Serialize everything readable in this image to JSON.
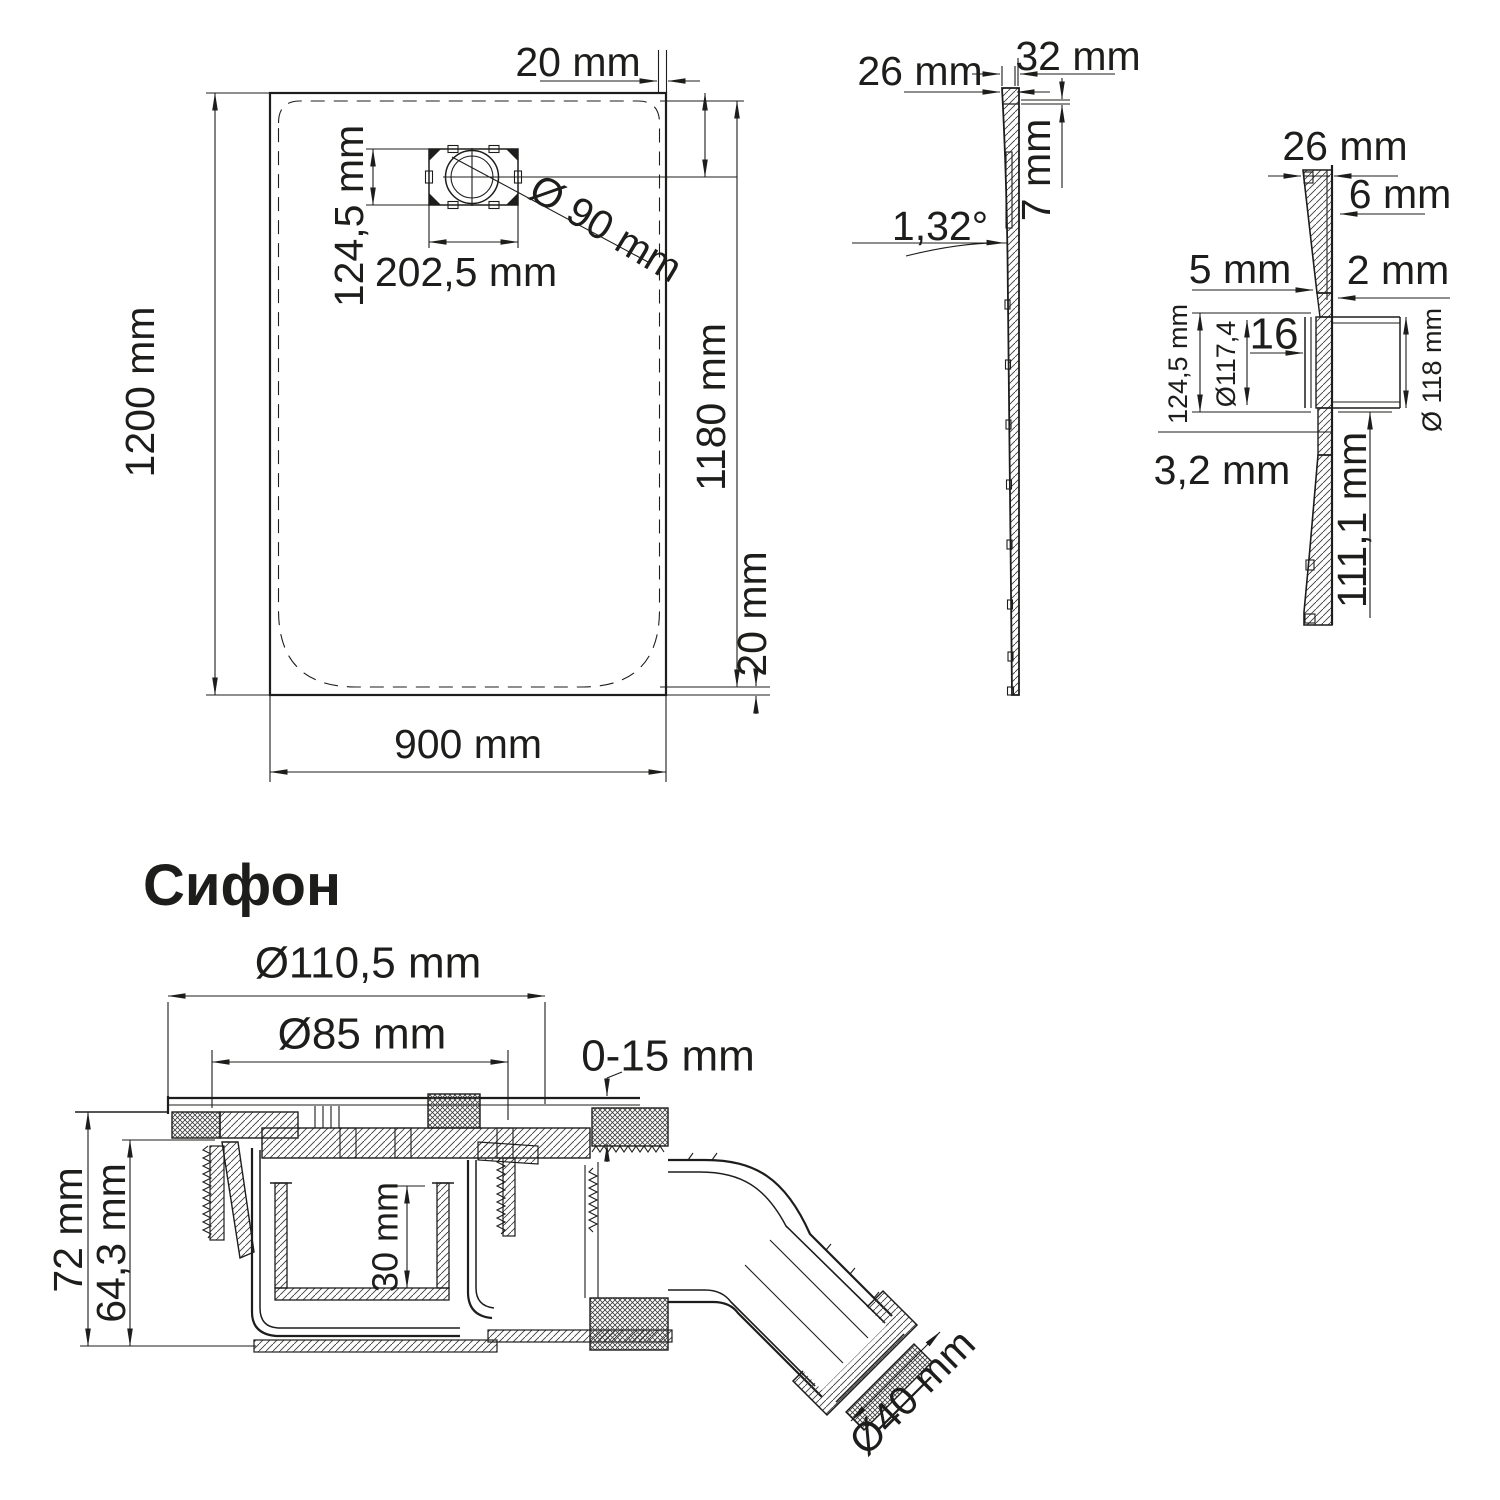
{
  "meta": {
    "line_color": "#1d1d1b",
    "accent_color": "#2b3a68",
    "background": "#ffffff"
  },
  "plan_view": {
    "top_offset": "20 mm",
    "drain_height": "124,5 mm",
    "drain_width": "202,5 mm",
    "drain_diameter": "Ø 90 mm",
    "length": "1200 mm",
    "inner_length": "1180 mm",
    "bottom_offset": "20 mm",
    "width": "900 mm"
  },
  "profile_view": {
    "edge_thickness": "26 mm",
    "top_width": "32 mm",
    "rim_height": "7 mm",
    "slope_angle": "1,32°"
  },
  "detail_view": {
    "edge_thickness": "26 mm",
    "lip_height": "6 mm",
    "step_width": "5 mm",
    "wall_thickness": "2 mm",
    "recess_depth": "16",
    "flange_height": "124,5 mm",
    "inner_diameter": "Ø117,4",
    "outer_diameter": "Ø 118 mm",
    "bottom_thickness": "3,2 mm",
    "drain_body_height": "111,1 mm"
  },
  "siphon_view": {
    "heading": "Сифон",
    "flange_diameter": "Ø110,5 mm",
    "grate_diameter": "Ø85 mm",
    "adjust_range": "0-15 mm",
    "total_height": "72 mm",
    "body_height": "64,3 mm",
    "water_seal_height": "30 mm",
    "outlet_diameter": "Ø40 mm"
  }
}
